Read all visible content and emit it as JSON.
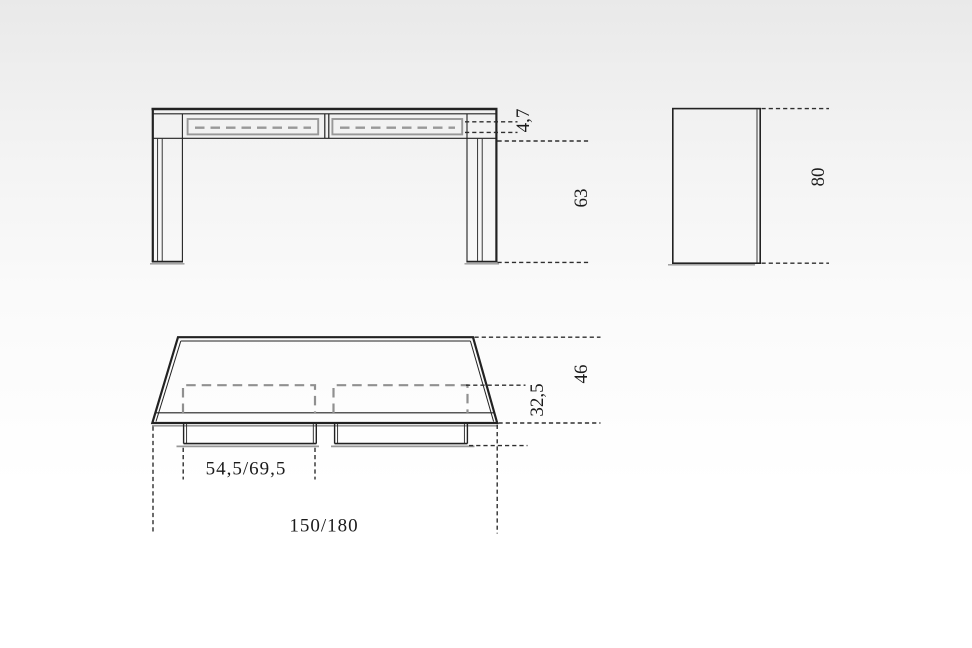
{
  "front_view": {
    "drawer_front_height": "4,7",
    "leg_height": "63"
  },
  "side_view": {
    "height": "80"
  },
  "plan_view": {
    "depth": "46",
    "drawer_depth": "32,5",
    "drawer_width": "54,5/69,5",
    "width": "150/180"
  },
  "colors": {
    "line": "#222222",
    "gray_detail": "#989898",
    "dimension_line": "#2e2e2e",
    "background_top": "#e9e9e9",
    "background_bottom": "#ffffff"
  }
}
